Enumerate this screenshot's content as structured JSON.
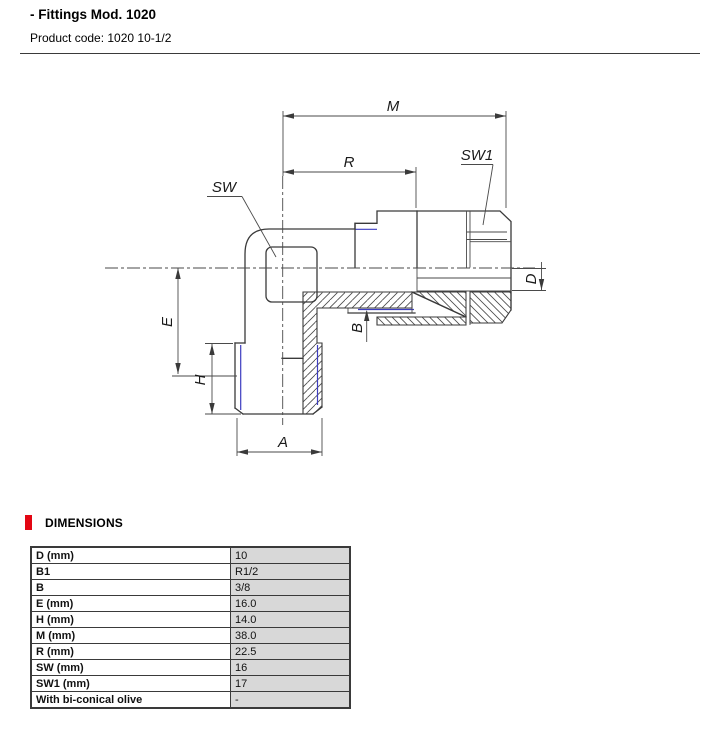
{
  "header": {
    "title": "- Fittings Mod. 1020",
    "product_code": "Product code: 1020 10-1/2"
  },
  "drawing": {
    "dim_labels": {
      "M": "M",
      "R": "R",
      "SW": "SW",
      "SW1": "SW1",
      "E": "E",
      "H": "H",
      "A": "A",
      "B": "B",
      "D": "D"
    },
    "thread_color": "#3d3dc0"
  },
  "dimensions_section": {
    "title": "DIMENSIONS",
    "accent_color": "#e30613"
  },
  "table": {
    "rows": [
      {
        "label": "D (mm)",
        "value": "10"
      },
      {
        "label": "B1",
        "value": "R1/2"
      },
      {
        "label": "B",
        "value": "3/8"
      },
      {
        "label": "E (mm)",
        "value": "16.0"
      },
      {
        "label": "H (mm)",
        "value": "14.0"
      },
      {
        "label": "M (mm)",
        "value": "38.0"
      },
      {
        "label": "R (mm)",
        "value": "22.5"
      },
      {
        "label": "SW (mm)",
        "value": "16"
      },
      {
        "label": "SW1 (mm)",
        "value": "17"
      },
      {
        "label": "With bi-conical olive",
        "value": "-"
      }
    ]
  }
}
